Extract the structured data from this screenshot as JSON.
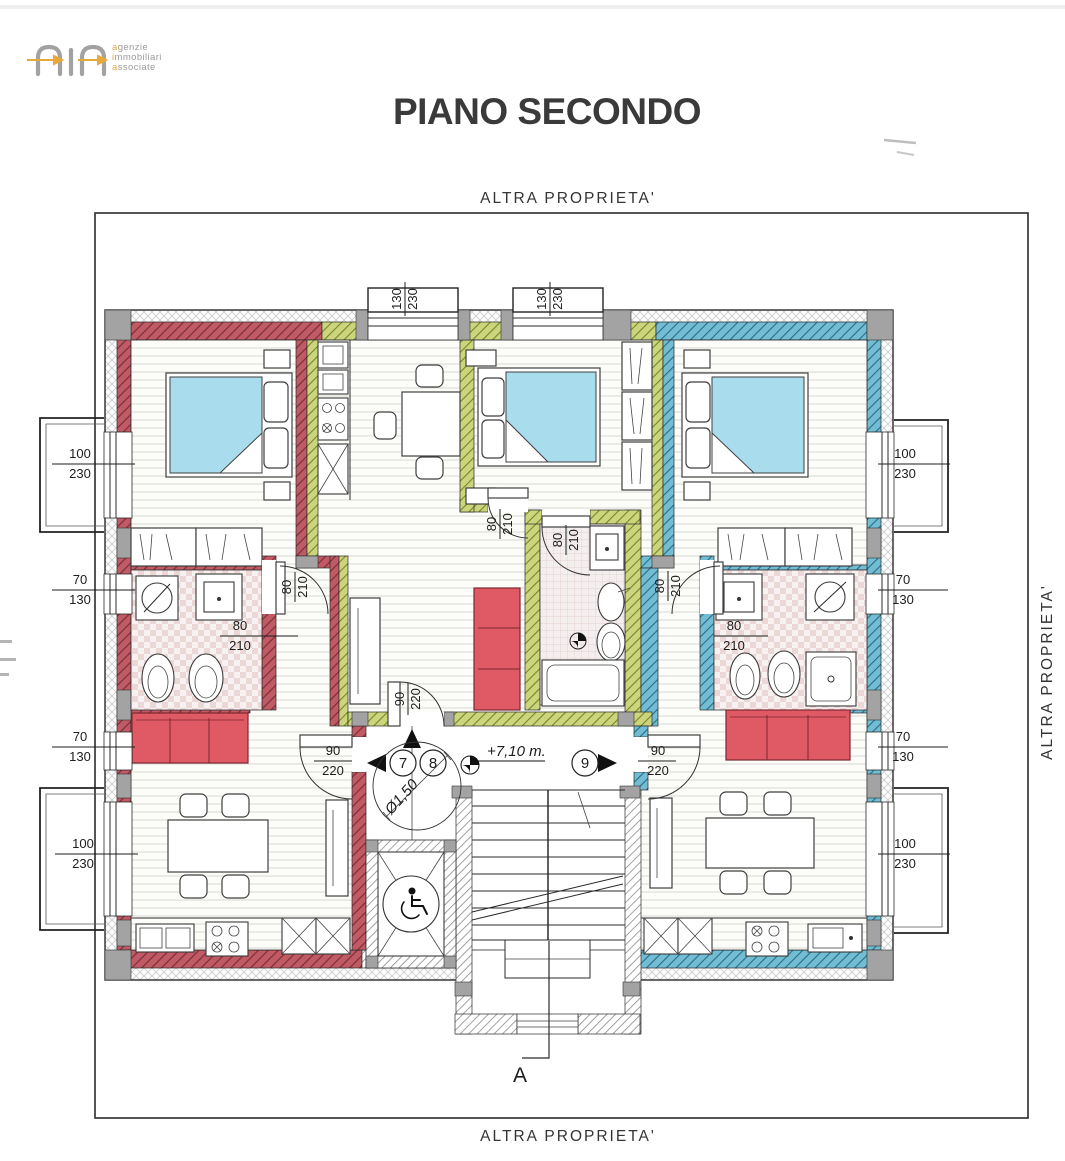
{
  "logo": {
    "word1_initial": "a",
    "word1_rest": "genzie",
    "word2_initial": "i",
    "word2_rest": "mmobiliari",
    "word3_initial": "a",
    "word3_rest": "ssociate"
  },
  "title": "PIANO SECONDO",
  "boundary": {
    "top": "ALTRA PROPRIETA'",
    "right": "ALTRA PROPRIETA'",
    "bottom": "ALTRA PROPRIETA'"
  },
  "dims": {
    "d130_230": {
      "w": "130",
      "h": "230"
    },
    "d100_230": {
      "w": "100",
      "h": "230"
    },
    "d70_130": {
      "w": "70",
      "h": "130"
    },
    "d80_210": {
      "w": "80",
      "h": "210"
    },
    "d90_220": {
      "w": "90",
      "h": "220"
    }
  },
  "annotations": {
    "level": "+7,10 m.",
    "stair_diameter": "Ø1,50",
    "section": "A",
    "door7": "7",
    "door8": "8",
    "door9": "9"
  },
  "colors": {
    "apartment_left_wall": "#c05a64",
    "apartment_middle_wall": "#ccd57c",
    "apartment_right_wall": "#72bdd3",
    "bed": "#a9dcec",
    "sofa": "#e05a66"
  }
}
